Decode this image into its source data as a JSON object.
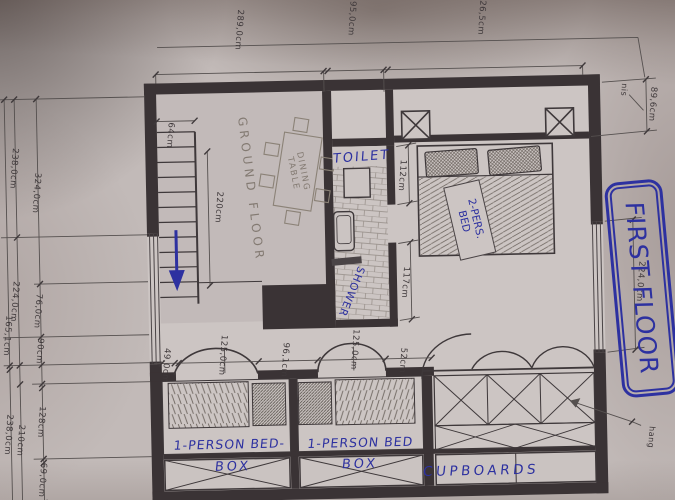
{
  "title": "FIRST FLOOR",
  "rooms": {
    "open_area": "GROUND FLOOR",
    "dining": {
      "line1": "DINING",
      "line2": "TABLE"
    },
    "toilet": "TOILET",
    "shower": "SHOWER",
    "double_bed": {
      "line1": "2-PERS.",
      "line2": "BED"
    },
    "bed_box_1": {
      "line1": "1-PERSON BED-",
      "line2": "BOX"
    },
    "bed_box_2": {
      "line1": "1-PERSON BED",
      "line2": "BOX"
    },
    "cupboards": "CUPBOARDS"
  },
  "annotations": {
    "niche": "nis",
    "hanging": "hang"
  },
  "dimensions": {
    "top": [
      "289,0cm",
      "95,0cm",
      "326,5cm"
    ],
    "right": [
      "89,6cm",
      "224,0cm"
    ],
    "left_outer": [
      "165,1cm",
      "238,0cm"
    ],
    "left_mid": [
      "238,0cm",
      "224,0cm",
      "210cm"
    ],
    "left_inner": [
      "324,0cm",
      "76,0cm",
      "90cm",
      "128cm",
      "69,0cm"
    ],
    "stairs": [
      "64cm",
      "220cm"
    ],
    "bathroom_wall": [
      "112cm",
      "117cm"
    ],
    "bottom": [
      "49,0cm",
      "125,0cm",
      "96,1cm",
      "125,0cm",
      "52cm"
    ]
  },
  "colors": {
    "ink": "#2d31a0",
    "wall": "#3a3335",
    "paper": "#c6bfbd"
  }
}
